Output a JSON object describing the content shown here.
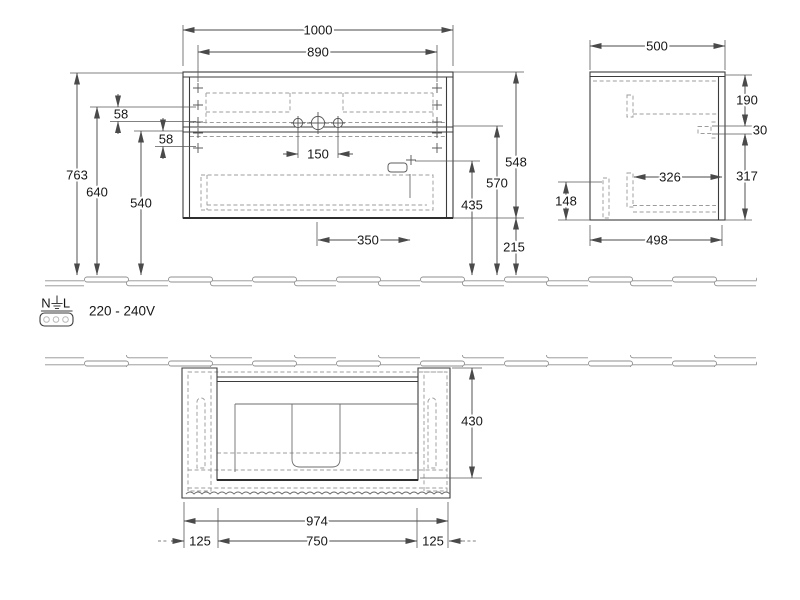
{
  "drawing": {
    "front_view": {
      "dims": {
        "overall_width": "1000",
        "mounting_width": "890",
        "overall_height": "763",
        "upper_rail": "640",
        "lower_rail": "540",
        "gap_upper": "58",
        "gap_lower": "58",
        "tap_spacing": "150",
        "drain_offset": "350",
        "carcass_height": "548",
        "basin_height": "570",
        "outlet_height": "435",
        "clearance": "215"
      }
    },
    "side_view": {
      "dims": {
        "overall_depth": "500",
        "top_section": "190",
        "basin_edge": "30",
        "lower_section": "317",
        "inner_depth": "326",
        "bracket_height": "148",
        "carcass_depth": "498"
      }
    },
    "plan_view": {
      "dims": {
        "installation_depth": "430",
        "carcass_width": "974",
        "inner_width": "750",
        "offset_left": "125",
        "offset_right": "125"
      }
    },
    "electrical": {
      "terminal_n": "N",
      "terminal_l": "L",
      "voltage": "220 - 240V"
    }
  }
}
